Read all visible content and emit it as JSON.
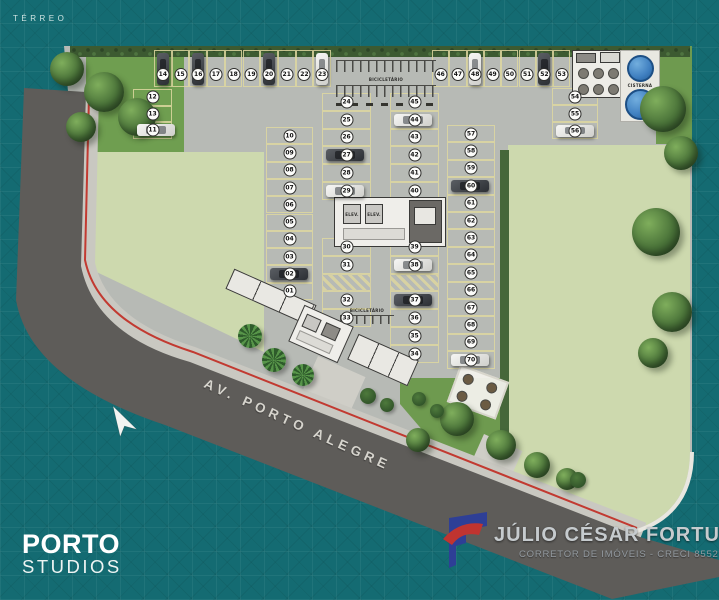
{
  "page": {
    "floor_label": "TÉRREO"
  },
  "street": {
    "name": "AV. PORTO ALEGRE"
  },
  "branding": {
    "project_name": "PORTO",
    "project_subtitle": "STUDIOS"
  },
  "realtor": {
    "name": "JÚLIO CÉSAR FORTUNA",
    "role": "CORRETOR DE IMÓVEIS - CRECI 8552"
  },
  "labels": {
    "bike_rack": "BICICLETÁRIO",
    "cistern": "CISTERNA",
    "elevator": "ELEV."
  },
  "colors": {
    "background_teal": "#146b72",
    "road": "#5e5c59",
    "sidewalk": "#c9c8c1",
    "pavement": "#b7bab5",
    "lawn_light": "#cdd9ae",
    "lawn_dark": "#6f9e50",
    "stall_line": "#ded7a0",
    "bike_lane_red": "#c23a31",
    "water_tank_blue": "#3f7fc0",
    "logo_blue": "#2e3f96",
    "logo_red": "#c03430"
  },
  "parking": {
    "rows": [
      {
        "id": "left-edge",
        "spots": [
          {
            "n": "12"
          },
          {
            "n": "13"
          },
          {
            "n": "11",
            "car": "white"
          }
        ]
      },
      {
        "id": "left-col",
        "spots": [
          {
            "n": "10"
          },
          {
            "n": "09"
          },
          {
            "n": "08"
          },
          {
            "n": "07"
          },
          {
            "n": "06"
          },
          {
            "n": "05"
          },
          {
            "n": "04"
          },
          {
            "n": "03"
          },
          {
            "n": "02",
            "car": "dark"
          },
          {
            "n": "01"
          }
        ]
      },
      {
        "id": "top-left",
        "spots": [
          {
            "n": "14",
            "car": "dark"
          },
          {
            "n": "15"
          },
          {
            "n": "16",
            "car": "dark"
          },
          {
            "n": "17"
          },
          {
            "n": "18"
          },
          {
            "n": "19"
          },
          {
            "n": "20",
            "car": "dark"
          },
          {
            "n": "21"
          },
          {
            "n": "22"
          },
          {
            "n": "23",
            "car": "white"
          }
        ]
      },
      {
        "id": "top-right",
        "spots": [
          {
            "n": "46"
          },
          {
            "n": "47"
          },
          {
            "n": "48",
            "car": "white"
          },
          {
            "n": "49"
          },
          {
            "n": "50"
          },
          {
            "n": "51"
          },
          {
            "n": "52",
            "car": "dark"
          },
          {
            "n": "53"
          }
        ]
      },
      {
        "id": "center-left-upper",
        "spots": [
          {
            "n": "24"
          },
          {
            "n": "25"
          },
          {
            "n": "26"
          },
          {
            "n": "27",
            "car": "dark"
          },
          {
            "n": "28"
          },
          {
            "n": "29",
            "car": "white"
          }
        ]
      },
      {
        "id": "center-left-lower",
        "spots": [
          {
            "n": "30"
          },
          {
            "n": "31"
          },
          {
            "hatch": true
          },
          {
            "n": "32"
          },
          {
            "n": "33"
          }
        ]
      },
      {
        "id": "center-right-upper",
        "spots": [
          {
            "n": "45"
          },
          {
            "n": "44",
            "car": "white"
          },
          {
            "n": "43"
          },
          {
            "n": "42"
          },
          {
            "n": "41"
          },
          {
            "n": "40"
          }
        ]
      },
      {
        "id": "center-right-lower",
        "spots": [
          {
            "n": "39"
          },
          {
            "n": "38",
            "car": "white"
          },
          {
            "hatch": true
          },
          {
            "n": "37",
            "car": "dark"
          },
          {
            "n": "36"
          },
          {
            "n": "35"
          },
          {
            "n": "34"
          }
        ]
      },
      {
        "id": "right-col-a",
        "spots": [
          {
            "n": "54"
          },
          {
            "n": "55"
          },
          {
            "n": "56",
            "car": "white"
          }
        ]
      },
      {
        "id": "right-col-b",
        "spots": [
          {
            "n": "57"
          },
          {
            "n": "58"
          },
          {
            "n": "59"
          },
          {
            "n": "60",
            "car": "dark"
          },
          {
            "n": "61"
          },
          {
            "n": "62"
          },
          {
            "n": "63"
          },
          {
            "n": "64"
          },
          {
            "n": "65"
          },
          {
            "n": "66"
          },
          {
            "n": "67"
          },
          {
            "n": "68"
          },
          {
            "n": "69"
          },
          {
            "n": "70",
            "car": "white"
          }
        ]
      }
    ]
  }
}
